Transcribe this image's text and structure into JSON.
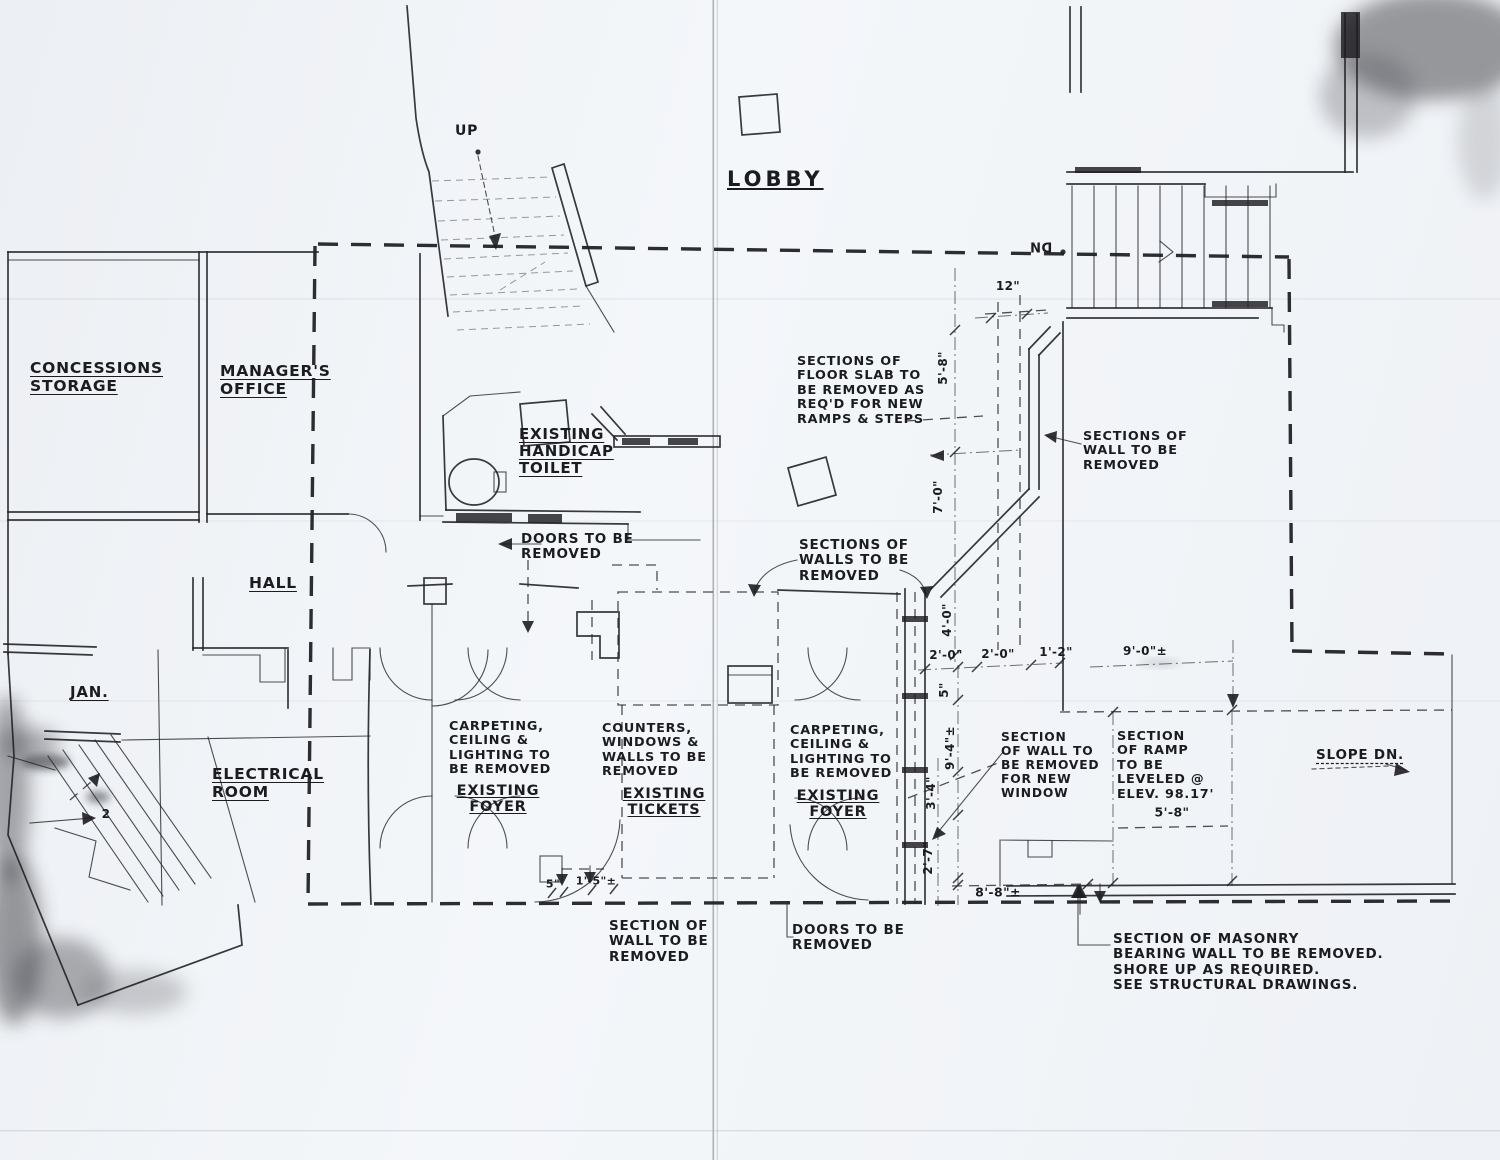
{
  "drawing": {
    "paper_color": "#f1f4f7",
    "ink_color": "#1e1e22"
  },
  "rooms": {
    "lobby": "LOBBY",
    "concessions_storage": [
      "CONCESSIONS",
      "STORAGE"
    ],
    "managers_office": [
      "MANAGER'S",
      "OFFICE"
    ],
    "handicap_toilet": [
      "EXISTING",
      "HANDICAP",
      "TOILET"
    ],
    "hall": "HALL",
    "jan": "JAN.",
    "electrical_room": [
      "ELECTRICAL",
      "ROOM"
    ]
  },
  "stairs": {
    "up_label": "UP",
    "dn_label": "DN",
    "slope_label": "SLOPE DN.",
    "step_count_note": "2"
  },
  "annotations": {
    "floor_slab": [
      "SECTIONS OF",
      "FLOOR SLAB TO",
      "BE REMOVED AS",
      "REQ'D FOR NEW",
      "RAMPS & STEPS"
    ],
    "wall_removed_right": [
      "SECTIONS OF",
      "WALL TO BE",
      "REMOVED"
    ],
    "doors_removed_top": [
      "DOORS TO BE",
      "REMOVED"
    ],
    "walls_removed_mid": [
      "SECTIONS OF",
      "WALLS TO BE",
      "REMOVED"
    ],
    "foyer_left_note": [
      "CARPETING,",
      "CEILING &",
      "LIGHTING TO",
      "BE REMOVED"
    ],
    "foyer_left_room": [
      "EXISTING",
      "FOYER"
    ],
    "tickets_note": [
      "COUNTERS,",
      "WINDOWS &",
      "WALLS TO BE",
      "REMOVED"
    ],
    "tickets_room": [
      "EXISTING",
      "TICKETS"
    ],
    "foyer_right_note": [
      "CARPETING,",
      "CEILING &",
      "LIGHTING TO",
      "BE REMOVED"
    ],
    "foyer_right_room": [
      "EXISTING",
      "FOYER"
    ],
    "window_wall": [
      "SECTION",
      "OF WALL TO",
      "BE REMOVED",
      "FOR NEW",
      "WINDOW"
    ],
    "ramp": [
      "SECTION",
      "OF RAMP",
      "TO BE",
      "LEVELED @",
      "ELEV. 98.17'"
    ],
    "ramp_dim": "5'-8\"",
    "wall_removed_bottom": [
      "SECTION OF",
      "WALL TO BE",
      "REMOVED"
    ],
    "doors_removed_bottom": [
      "DOORS TO BE",
      "REMOVED"
    ],
    "masonry": [
      "SECTION OF MASONRY",
      "BEARING WALL TO BE REMOVED.",
      "SHORE UP AS REQUIRED.",
      "SEE STRUCTURAL DRAWINGS."
    ]
  },
  "dimensions": {
    "d12": "12\"",
    "d5_8": "5'-8\"",
    "d7_0": "7'-0\"",
    "d4_0": "4'-0\"",
    "d2_0a": "2'-0\"",
    "d2_0b": "2'-0\"",
    "d1_2": "1'-2\"",
    "d9_0": "9'-0\"±",
    "d5a": "5\"",
    "d9_4": "9'-4\"±",
    "d3_4": "3'-4\"",
    "d2_7": "2'-7\"",
    "d5b": "5\"",
    "d1_5": "1'-5\"±",
    "d8_8": "8'-8\"±"
  }
}
